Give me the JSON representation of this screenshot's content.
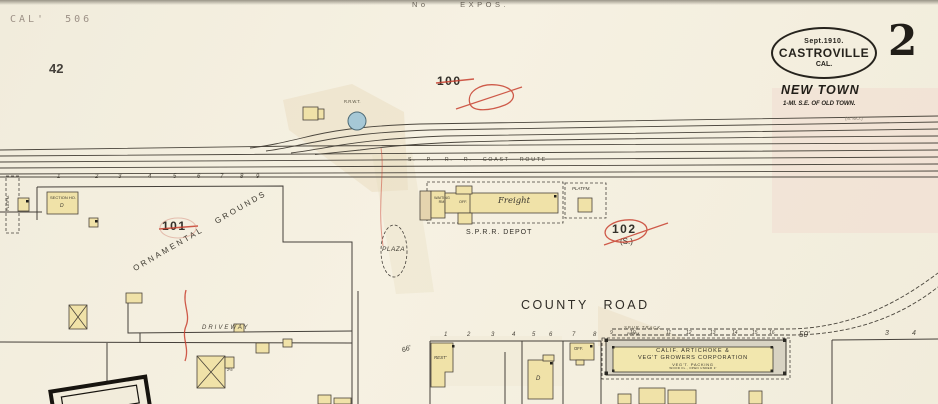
{
  "colors": {
    "paper": "#f3eedf",
    "ink": "#3c382f",
    "red_pencil": "#c8402f",
    "building_yellow": "#f0e2a8",
    "water_tank_blue": "#a6c8d6",
    "pink_wash": "#f2d9d0",
    "tan_wash": "#e9dcc0"
  },
  "header": {
    "plate_code": "CAL' 506",
    "page_number": "42",
    "top_note": "No EXPOS."
  },
  "badge": {
    "date": "Sept.1910.",
    "city": "CASTROVILLE",
    "state": "CAL.",
    "sheet_number": "2",
    "subtitle": "NEW TOWN",
    "subtitle_note": "1-MI. S.E. OF OLD TOWN."
  },
  "railroad": {
    "route_label": "S. P. R. R. COAST ROUTE",
    "corner_note": "(N. MO.)",
    "water_tank_label": "R.R.W.T.",
    "spur_label": "SPUR TRACK."
  },
  "areas": {
    "block_100": "100",
    "block_101": "101",
    "block_102": "102",
    "block_102_sub": "(S.)",
    "ornamental_grounds": "ORNAMENTAL GROUNDS",
    "plaza": "PLAZA",
    "driveway": "DRIVEWAY",
    "county_road": "COUNTY ROAD",
    "dim_50": "50'",
    "dim_66": "66'"
  },
  "depot": {
    "waiting_room": "WAITING RM.",
    "office": "OFF.",
    "freight": "Freight",
    "name": "S.P.R.R. DEPOT",
    "platform": "PLATFM.",
    "platform_left": "PLATFM.",
    "platform_small": "PLTFM."
  },
  "warehouse": {
    "line1": "CALIF. ARTICHOKE &",
    "line2": "VEG'T GROWERS CORPORATION",
    "line3": "VEG'T. PACKING",
    "line4": "WOOD FL., OPEN UNDER 3'"
  },
  "buildings": {
    "section_house": "SECTION HO.",
    "section_marker": "D",
    "rest": "REST'",
    "dwelling_marker": "D",
    "office_small": "OFF.",
    "barn_note": "2½"
  },
  "lots": {
    "left": [
      "1",
      "2",
      "3",
      "4",
      "5",
      "6",
      "7",
      "8",
      "9"
    ],
    "center": [
      "1",
      "2",
      "3",
      "4",
      "5",
      "6",
      "7",
      "8"
    ],
    "spur": [
      "9",
      "10",
      "11",
      "12",
      "13",
      "14",
      "15",
      "16"
    ],
    "right": [
      "3",
      "4"
    ]
  }
}
